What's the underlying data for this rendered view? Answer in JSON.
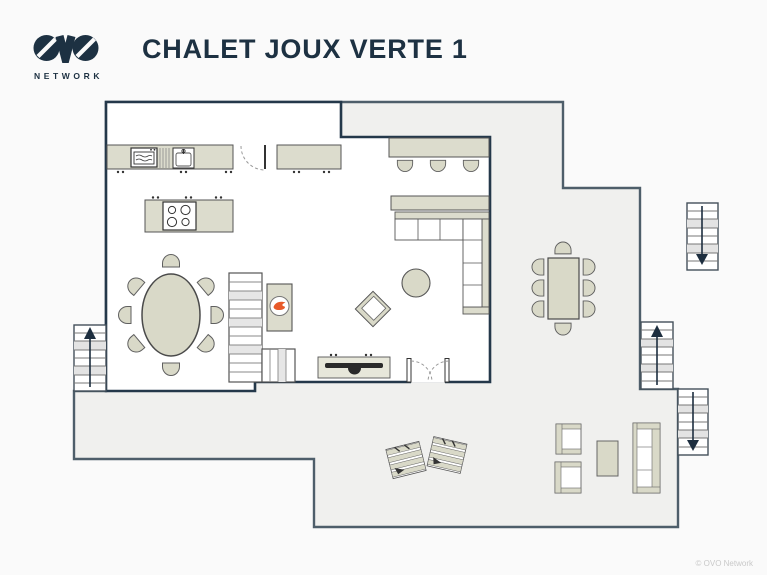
{
  "header": {
    "logo_text": "OVO",
    "logo_subtext": "NETWORK",
    "title": "CHALET JOUX VERTE 1"
  },
  "footer": {
    "copyright": "© OVO Network"
  },
  "colors": {
    "page_bg": "#fafafa",
    "interior_bg": "#ffffff",
    "terrace_bg": "#f0f0ee",
    "interior_wall": "#24384a",
    "terrace_outline": "#4e5e6a",
    "furniture_fill": "#dcdccd",
    "furniture_outline": "#555555",
    "stair_tread_shade": "#e3e3e3",
    "arrow": "#1d2e3f",
    "flame": "#e85a2a",
    "tv": "#2a2a2a",
    "title_color": "#1d3142",
    "copyright_color": "#c9c9c9"
  },
  "floorplan": {
    "floor_name": "main floor with wrap-around terrace",
    "elements": [
      "kitchen-counter-with-oven-and-sink",
      "kitchen-entry-door",
      "kitchen-counter-right",
      "kitchen-island-hob",
      "oval-dining-table-8-chairs",
      "internal-staircase",
      "fireplace",
      "bar-counter-3-stools",
      "sideboard",
      "corner-sofa",
      "round-coffee-table",
      "corner-armchair",
      "tv-unit",
      "french-doors-to-terrace",
      "terrace-dining-table-8-chairs",
      "outdoor-armchair-x2",
      "outdoor-coffee-table",
      "outdoor-sofa",
      "sun-lounger-x2",
      "external-staircase-up-left",
      "external-staircase-up-right",
      "external-staircase-down-right",
      "external-staircase-down-top-right"
    ]
  }
}
